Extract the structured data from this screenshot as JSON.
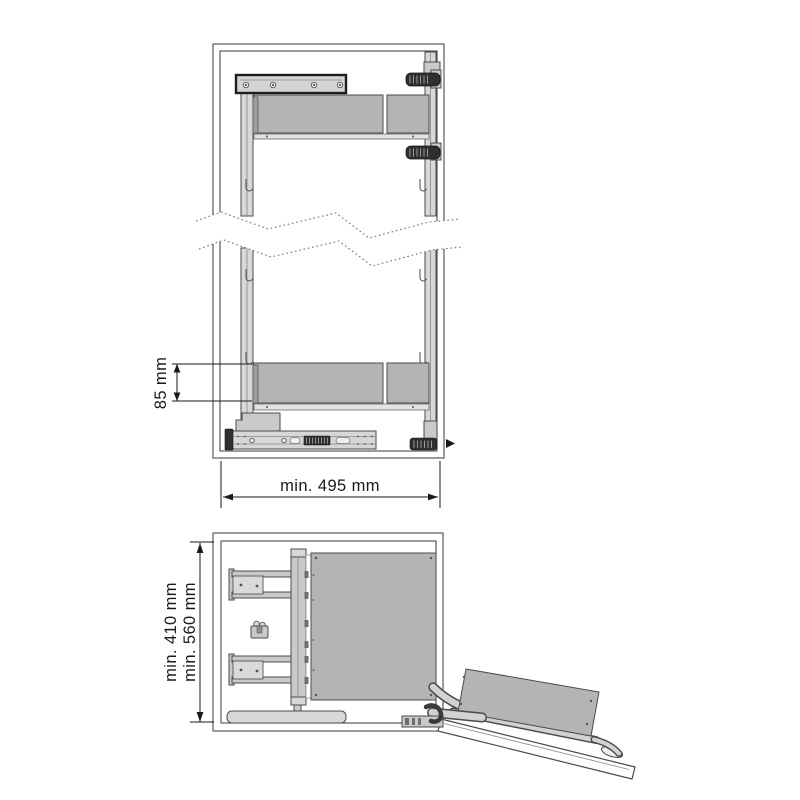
{
  "colors": {
    "background": "#ffffff",
    "line": "#4b4b4b",
    "dark": "#2f2f2f",
    "panel": "#b4b4b4",
    "rail": "#d8d8d8",
    "mid": "#c9c9c9",
    "text": "#1a1a1a"
  },
  "front_view": {
    "dimension_shelf_pitch": "85 mm",
    "dimension_width": "min. 495 mm"
  },
  "top_view": {
    "dimension_depth_min": "min. 410 mm",
    "dimension_depth_max": "min. 560 mm"
  }
}
